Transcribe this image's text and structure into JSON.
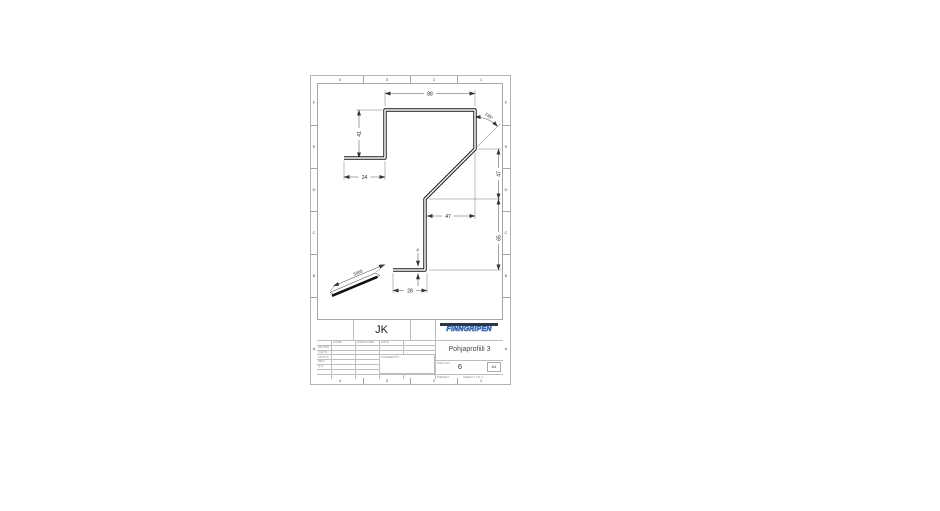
{
  "sheet": {
    "zones": {
      "top": [
        "4",
        "3",
        "2",
        "1"
      ],
      "bottom": [
        "4",
        "3",
        "2",
        "1"
      ],
      "left": [
        "F",
        "E",
        "D",
        "C",
        "B",
        "A"
      ],
      "right": [
        "F",
        "E",
        "D",
        "C",
        "B",
        "A"
      ]
    }
  },
  "dimensions": {
    "top_width": "88",
    "left_web_height": "41",
    "left_flange_width": "24",
    "bend_angle": "135°",
    "diagonal_rise": "47",
    "lower_web_height": "65",
    "diagonal_run": "47",
    "bottom_flange_width": "28",
    "thickness": "4",
    "profile_length": "5000"
  },
  "title_block": {
    "author": "JK",
    "logo_text": "FINNGRIPEN",
    "title": "Pohjaprofiili 3",
    "dwg_no": "6",
    "paper_size": "A4",
    "labels": {
      "dwg_no_label": "DWG NO.",
      "weight_label": "WEIGHT:",
      "sheet_label": "SHEET 1 OF 1",
      "comments_label": "COMMENTS:"
    },
    "grid": {
      "col_headers": [
        "NAME",
        "SIGNATURE",
        "DATE"
      ],
      "row_labels": [
        "DRAWN",
        "CHK'D",
        "APPV'D",
        "MFG",
        "Q.A"
      ]
    }
  }
}
